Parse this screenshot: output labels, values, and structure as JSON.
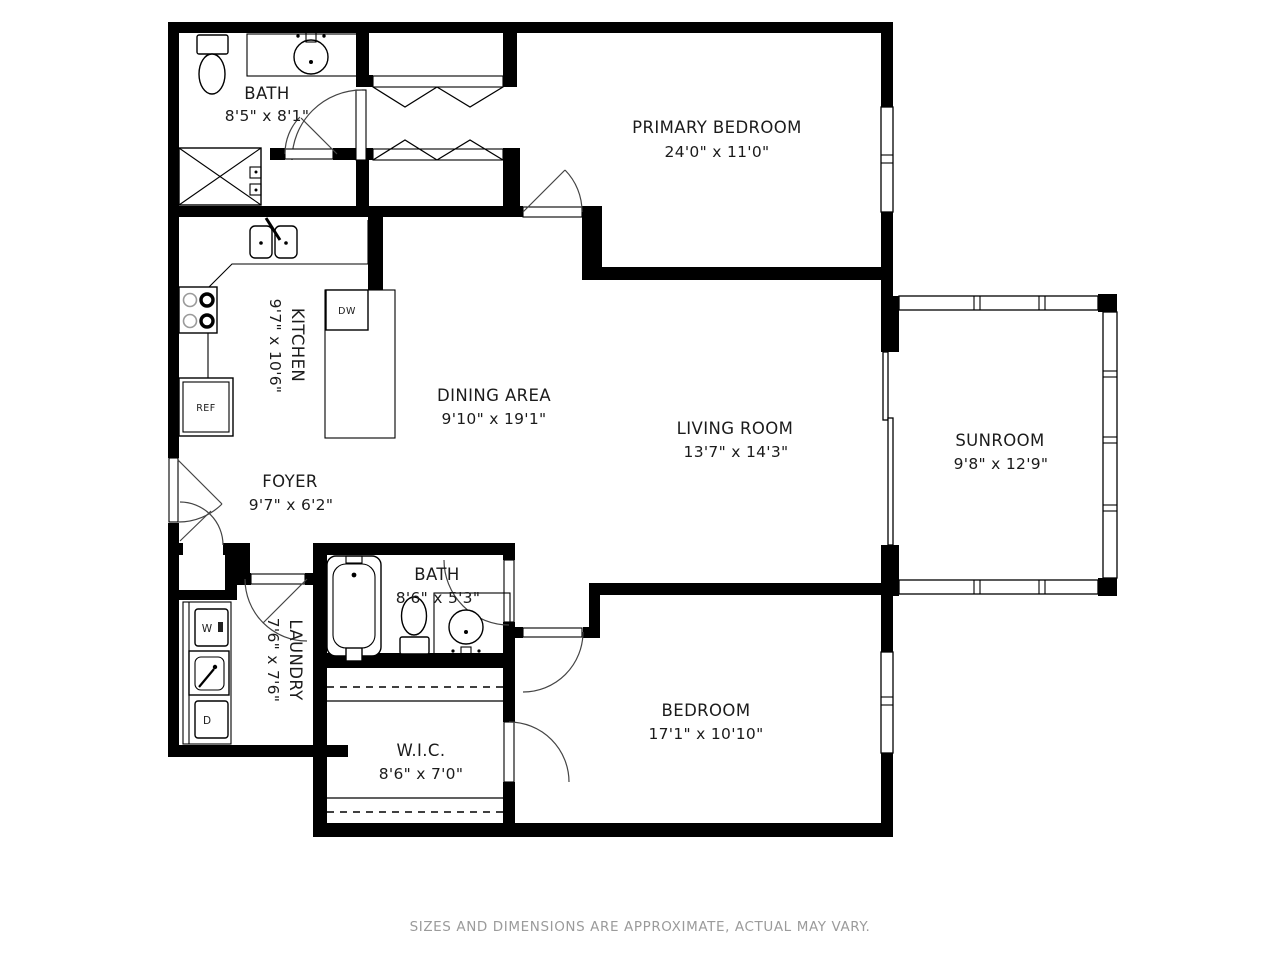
{
  "plan": {
    "disclaimer": "SIZES AND DIMENSIONS ARE APPROXIMATE, ACTUAL MAY VARY.",
    "rooms": [
      {
        "id": "bath-1",
        "name": "BATH",
        "dims": "8'5\" x 8'1\""
      },
      {
        "id": "primary-bedroom",
        "name": "PRIMARY BEDROOM",
        "dims": "24'0\" x 11'0\""
      },
      {
        "id": "kitchen",
        "name": "KITCHEN",
        "dims": "9'7\" x 10'6\""
      },
      {
        "id": "dining-area",
        "name": "DINING AREA",
        "dims": "9'10\" x 19'1\""
      },
      {
        "id": "living-room",
        "name": "LIVING ROOM",
        "dims": "13'7\" x 14'3\""
      },
      {
        "id": "sunroom",
        "name": "SUNROOM",
        "dims": "9'8\" x 12'9\""
      },
      {
        "id": "foyer",
        "name": "FOYER",
        "dims": "9'7\" x 6'2\""
      },
      {
        "id": "bath-2",
        "name": "BATH",
        "dims": "8'6\" x 5'3\""
      },
      {
        "id": "laundry",
        "name": "LAUNDRY",
        "dims": "7'6\" x 7'6\""
      },
      {
        "id": "walk-in-closet",
        "name": "W.I.C.",
        "dims": "8'6\" x 7'0\""
      },
      {
        "id": "bedroom",
        "name": "BEDROOM",
        "dims": "17'1\" x 10'10\""
      }
    ],
    "appliance_labels": {
      "dishwasher": "DW",
      "refrigerator": "REF",
      "washer": "W",
      "dryer": "D"
    },
    "colors": {
      "wall": "#000000",
      "background": "#ffffff",
      "label_text": "#1b1b1b",
      "disclaimer_text": "#9b9b9b"
    }
  }
}
